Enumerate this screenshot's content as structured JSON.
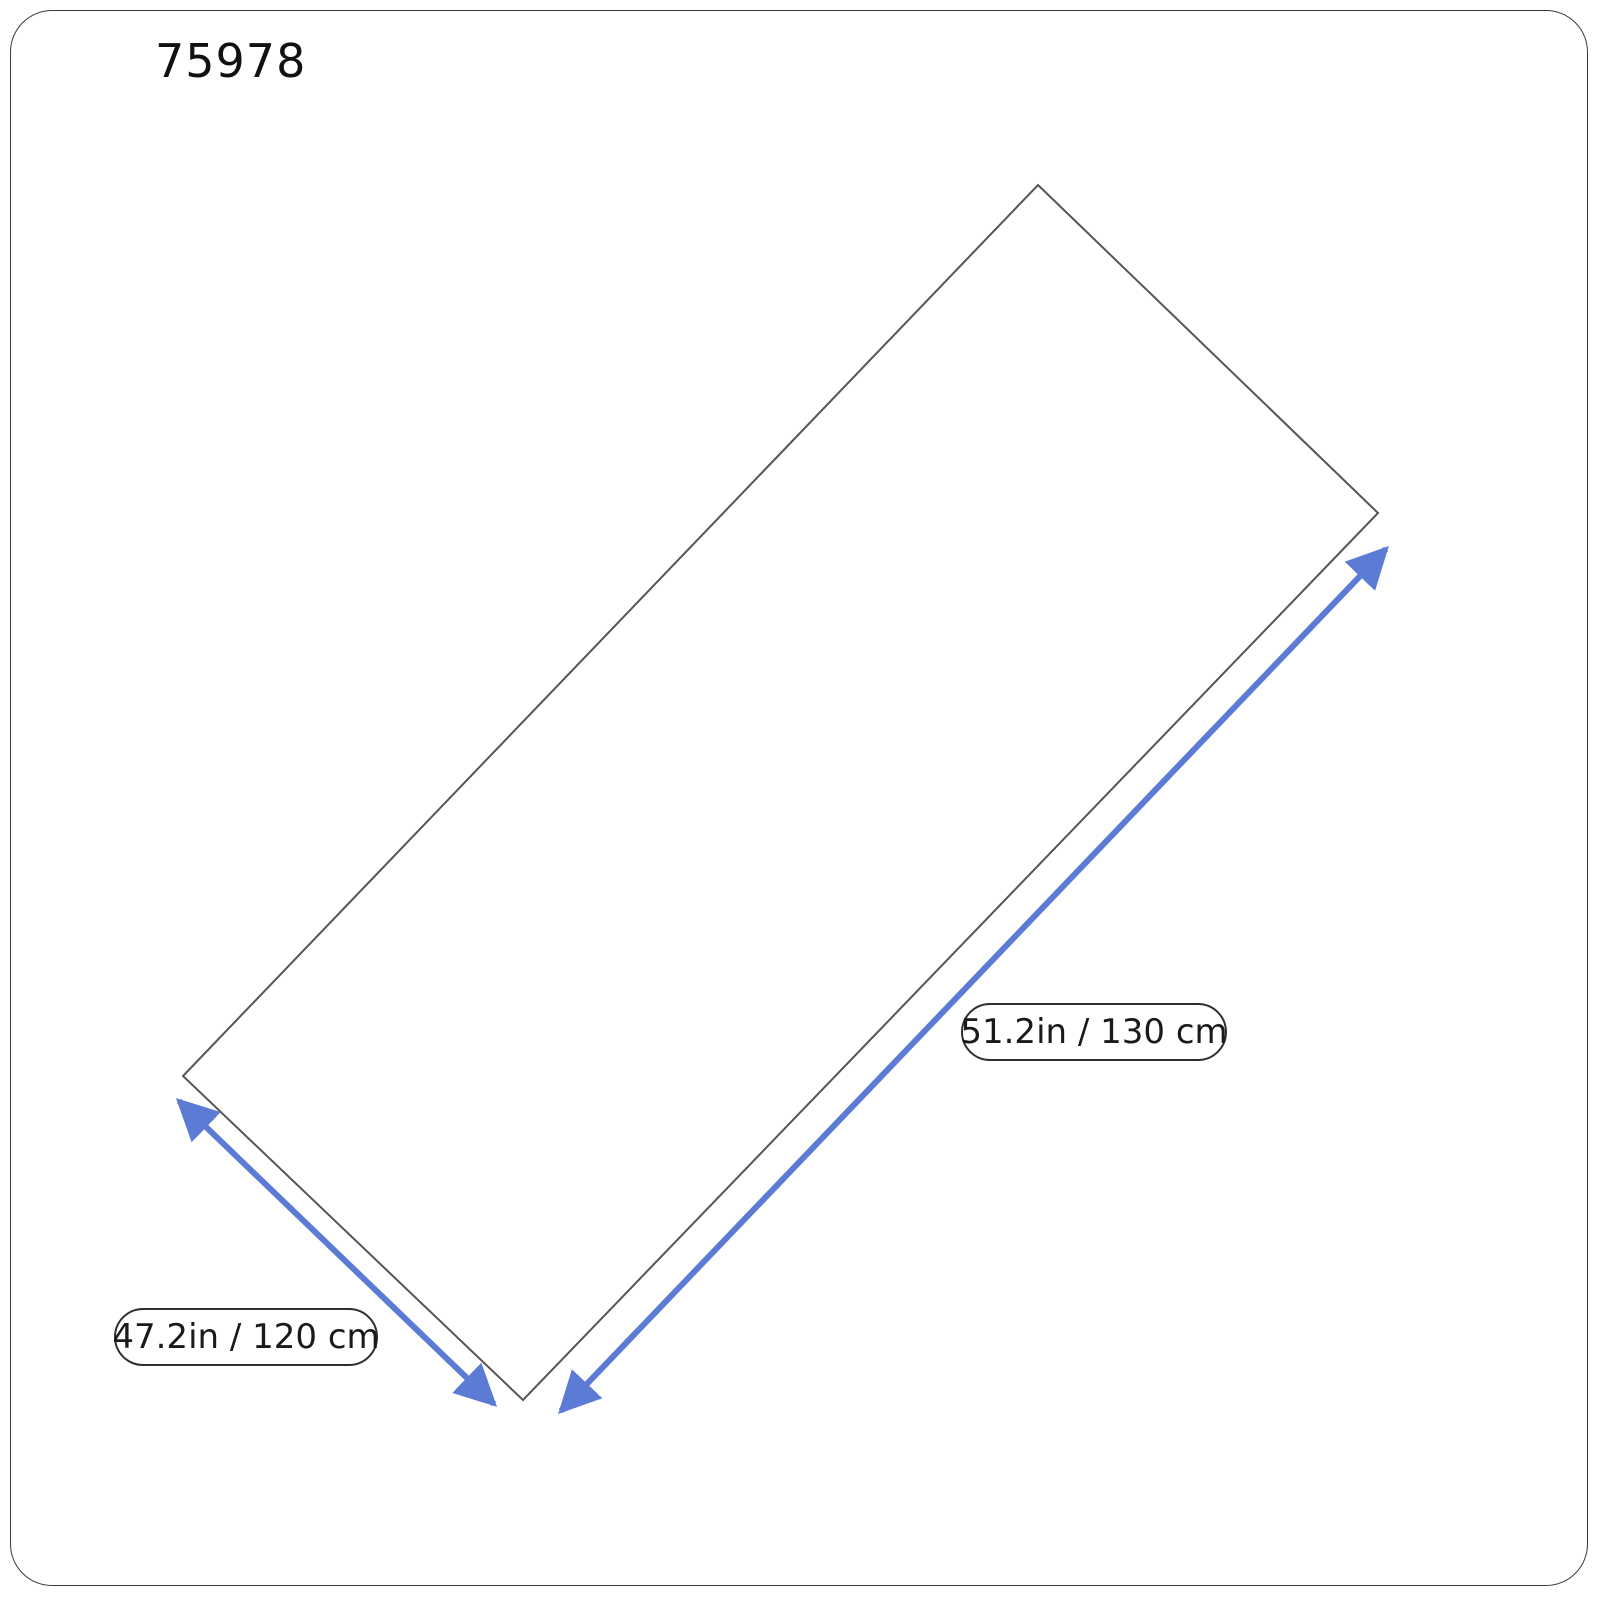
{
  "title": "75978",
  "diagram": {
    "labels": {
      "long_side": "51.2in / 130 cm",
      "short_side": "47.2in / 120 cm"
    },
    "colors": {
      "arrow_blue": "#5b7bd5",
      "outline_gray": "#555555",
      "pill_border": "#2f2f2f",
      "text": "#1a1a1a"
    }
  }
}
